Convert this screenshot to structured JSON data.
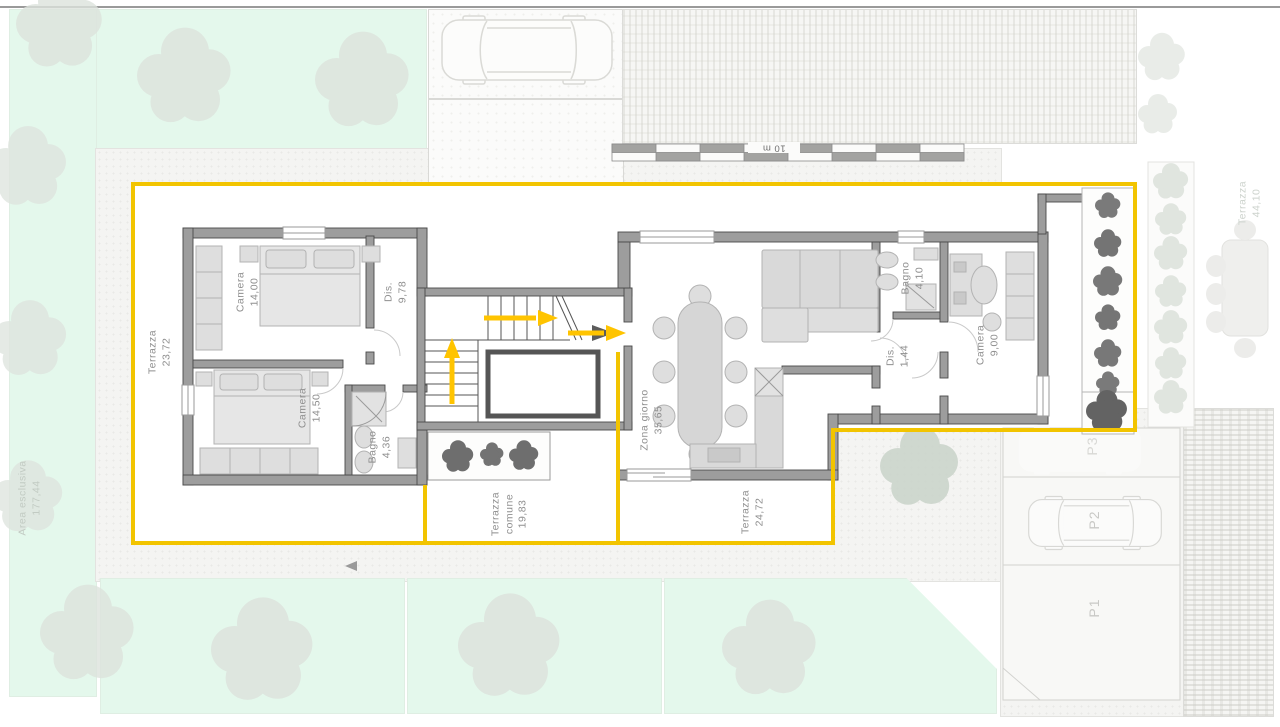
{
  "labels": {
    "terrazza_left": {
      "name": "Terrazza",
      "area": "23,72"
    },
    "camera_1": {
      "name": "Camera",
      "area": "14,00"
    },
    "dis_1": {
      "name": "Dis.",
      "area": "9,78"
    },
    "camera_2": {
      "name": "Camera",
      "area": "14,50"
    },
    "bagno_1": {
      "name": "Bagno",
      "area": "4,36"
    },
    "terrazza_comune": {
      "name": "Terrazza",
      "qualifier": "comune",
      "area": "19,83"
    },
    "zona_giorno": {
      "name": "Zona giorno",
      "area": "35,65"
    },
    "terrazza_south": {
      "name": "Terrazza",
      "area": "24,72"
    },
    "bagno_2": {
      "name": "Bagno",
      "area": "4,10"
    },
    "dis_2": {
      "name": "Dis.",
      "area": "1,44"
    },
    "camera_3": {
      "name": "Camera",
      "area": "9,00"
    },
    "area_esclusiva": {
      "name": "Area esclusiva",
      "area": "177,44"
    },
    "terrazza_adjacent": {
      "name": "Terrazza",
      "area": "44,10"
    },
    "parking": {
      "p1": "P1",
      "p2": "P2",
      "p3": "P3"
    },
    "scale": "10 m"
  },
  "colors": {
    "boundary_yellow": "#f2c400",
    "arrow_yellow": "#ffc400",
    "wall_gray": "#9d9d9d",
    "garden_green": "#e4f8ec",
    "label_gray": "#8f8f8f",
    "tree_dark": "#707070"
  }
}
